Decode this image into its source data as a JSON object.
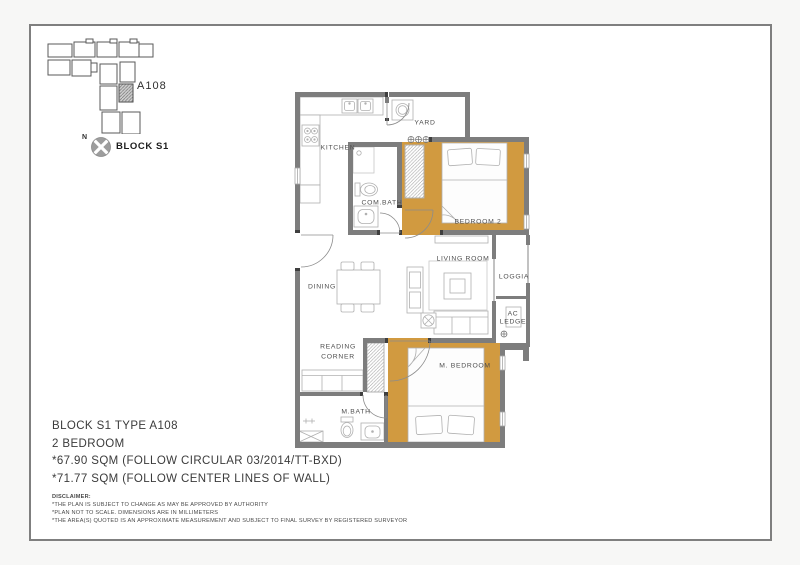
{
  "sheet": {
    "keyplan": {
      "north_label": "N",
      "block_label": "BLOCK S1",
      "unit_label": "A108"
    },
    "floor_plan": {
      "rooms": {
        "kitchen": "KITCHEN",
        "yard": "YARD",
        "com_bath": "COM.BATH",
        "bedroom2": "BEDROOM 2",
        "living_room": "LIVING  ROOM",
        "dining": "DINING",
        "loggia": "LOGGIA",
        "ac_ledge_line1": "AC",
        "ac_ledge_line2": "LEDGE",
        "reading_line1": "READING",
        "reading_line2": "CORNER",
        "m_bedroom": "M. BEDROOM",
        "m_bath": "M.BATH"
      }
    },
    "title_block": {
      "line1": "BLOCK S1 TYPE A108",
      "line2": "2 BEDROOM",
      "line3": "*67.90  SQM (FOLLOW CIRCULAR 03/2014/TT-BXD)",
      "line4": "*71.77  SQM (FOLLOW CENTER LINES OF WALL)"
    },
    "disclaimer": {
      "heading": "DISCLAIMER:",
      "lines": [
        "*THE PLAN IS SUBJECT TO CHANGE AS MAY BE APPROVED BY AUTHORITY",
        "*PLAN NOT TO SCALE. DIMENSIONS ARE IN MILLIMETERS",
        "*THE AREA(S) QUOTED IS AN APPROXIMATE MEASUREMENT AND SUBJECT TO FINAL SURVEY BY REGISTERED SURVEYOR"
      ]
    },
    "colors": {
      "wall_gray": "#7d7d7d",
      "floor_accent_orange": "#d19a40",
      "furniture_line": "#b0b0b0",
      "sheet_border": "#7f7f7f"
    }
  }
}
